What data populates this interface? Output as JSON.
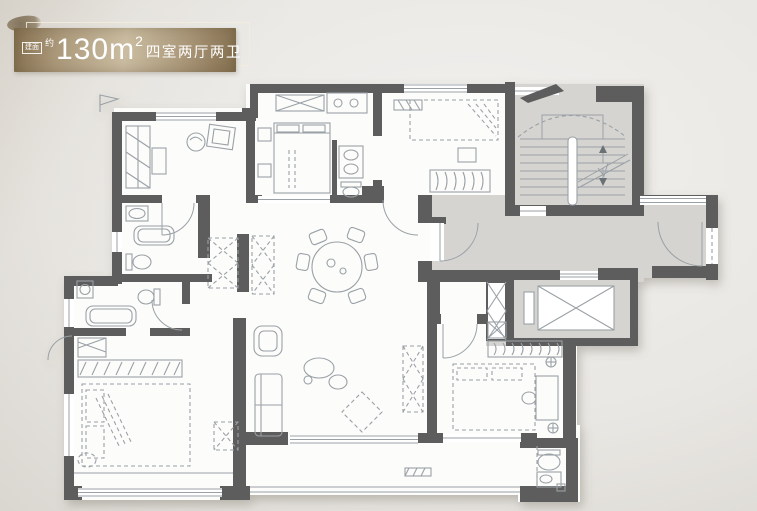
{
  "badge": {
    "prefix_box": "建面",
    "approx": "约",
    "area": "130m",
    "area_exp": "2",
    "layout": "四室两厅两卫"
  },
  "palette": {
    "wall": "#5d5d5d",
    "room": "#fcfcfb",
    "common": "#d5d4d1",
    "furn": "#9aa1a6",
    "bg_center": "#f1f0ee",
    "bg_edge": "#c6c2ba",
    "gold_dark": "#84704f",
    "gold_mid": "#ab987a",
    "gold_light": "#cbbda1",
    "badge_text": "#ffffff"
  },
  "icons": {
    "north_flag": "pennant-outline",
    "stairs_up_arrow": "triangle-up",
    "stairs_down_arrow": "triangle-down",
    "elevator_car": "crossed-box",
    "shaft_duct": "crossed-cells",
    "door_swing": "quarter-arc"
  }
}
